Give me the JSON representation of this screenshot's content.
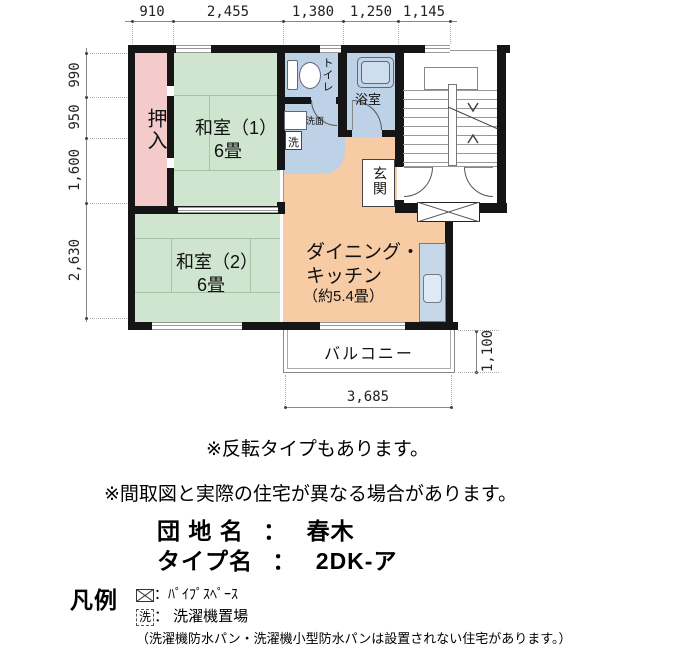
{
  "plan": {
    "dims": {
      "top": [
        "910",
        "2,455",
        "1,380",
        "1,250",
        "1,145"
      ],
      "left": [
        "990",
        "950",
        "1,600",
        "2,630"
      ],
      "bottom": "3,685",
      "right": "1,100"
    },
    "rooms": {
      "oshiire": "押入",
      "washitsu1": "和室（1）",
      "washitsu1_size": "6畳",
      "washitsu2": "和室（2）",
      "washitsu2_size": "6畳",
      "toilet": "トイレ",
      "bath": "浴室",
      "senmen": "洗面",
      "washer": "洗",
      "genkan": "玄関",
      "dk_line1": "ダイニング・",
      "dk_line2": "キッチン",
      "dk_line3": "（約5.4畳）",
      "balcony": "バルコニー"
    }
  },
  "notes": {
    "flip": "※反転タイプもあります。",
    "difference": "※間取図と実際の住宅が異なる場合があります。"
  },
  "info": {
    "estate_label": "団 地 名",
    "type_label": "タイプ名",
    "colon": "：",
    "estate_value": "春木",
    "type_value": "2DK-ア"
  },
  "legend": {
    "title": "凡例",
    "pipe_label": "：ﾊﾟｲﾌﾟｽﾍﾟｰｽ",
    "washer_symbol": "洗",
    "washer_label": "： 洗濯機置場",
    "note": "（洗濯機防水パン・洗濯機小型防水パンは設置されない住宅があります。）"
  },
  "colors": {
    "wall": "#151515",
    "tatami": "#cfe5cf",
    "closet": "#f5caca",
    "water": "#bdd1e7",
    "dining_kitchen": "#f7cba3",
    "counter": "#c6d7e9"
  }
}
